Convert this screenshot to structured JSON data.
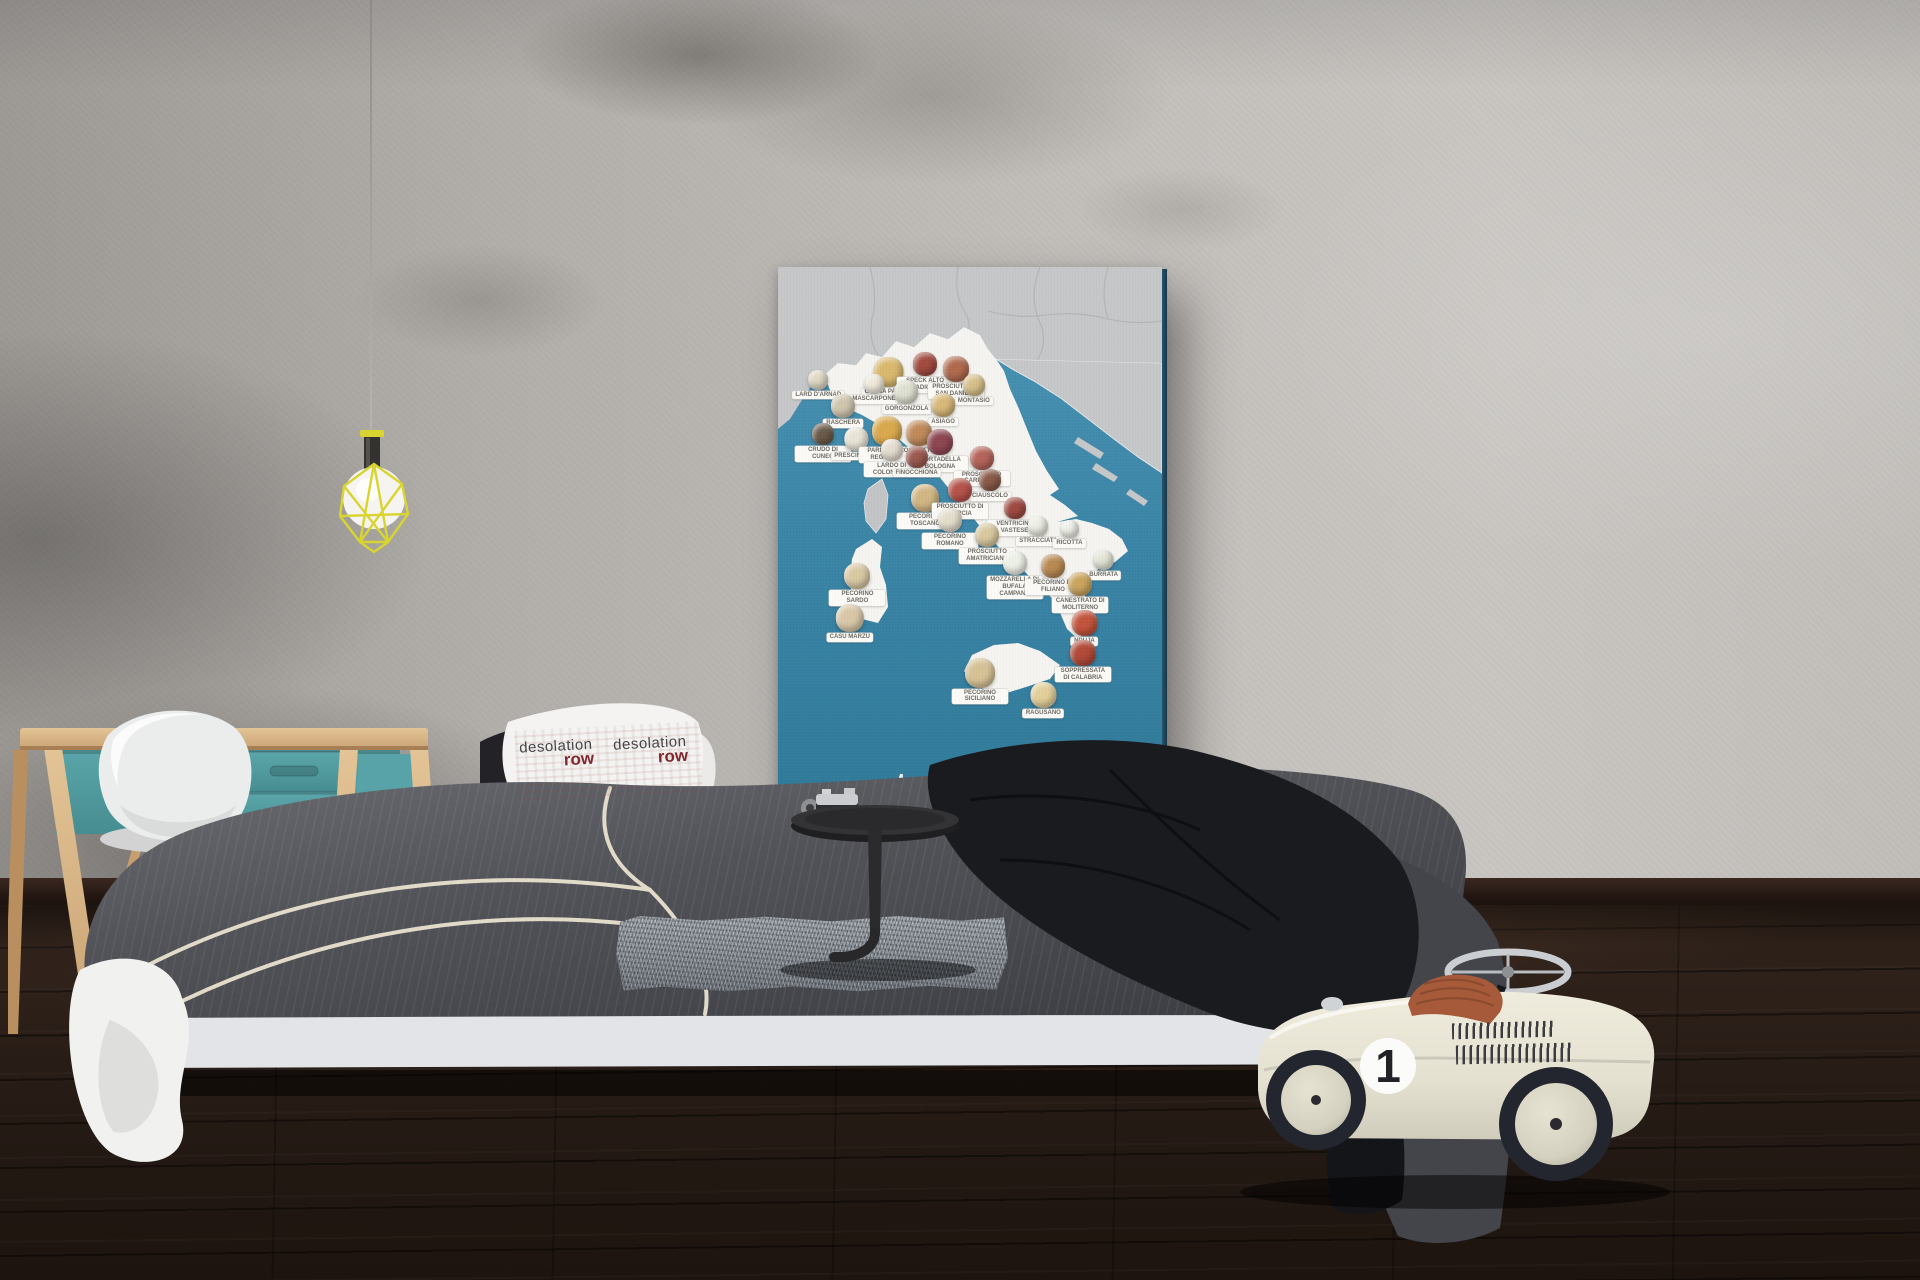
{
  "poster": {
    "brand_bold": "taste",
    "brand_light": "atlas",
    "url": "www.tasteatlas.com/italy",
    "sea_color": "#3e86a8",
    "land_color": "#c6c7c8",
    "italy_color": "#f5f4f0",
    "items": [
      {
        "label": "LARD D'ARNAD",
        "x": 10.5,
        "y": 17.8,
        "c": "#dfd8c4",
        "s": 20
      },
      {
        "label": "GRANA PADANO",
        "x": 28.9,
        "y": 15.7,
        "c": "#d9b86e",
        "s": 30
      },
      {
        "label": "SPECK ALTO ADIGE",
        "x": 38.3,
        "y": 14.8,
        "c": "#a24a40",
        "s": 24
      },
      {
        "label": "PROSCIUTTO DI SAN DANIELE",
        "x": 46.3,
        "y": 15.5,
        "c": "#b06a4e",
        "s": 26
      },
      {
        "label": "MONTASIO",
        "x": 51.0,
        "y": 18.5,
        "c": "#d8c08a",
        "s": 22
      },
      {
        "label": "MASCARPONE",
        "x": 25.0,
        "y": 18.6,
        "c": "#eee9da",
        "s": 20
      },
      {
        "label": "GORGONZOLA",
        "x": 33.5,
        "y": 19.6,
        "c": "#dde0cf",
        "s": 24
      },
      {
        "label": "ASIAGO",
        "x": 43.0,
        "y": 21.8,
        "c": "#d9b87a",
        "s": 24
      },
      {
        "label": "RASCHERA",
        "x": 17.0,
        "y": 22.1,
        "c": "#cfc6ae",
        "s": 24
      },
      {
        "label": "CRUDO DI CUNEO",
        "x": 11.7,
        "y": 27.1,
        "c": "#6b5b4a",
        "s": 22
      },
      {
        "label": "PRESCINSÊUA",
        "x": 20.3,
        "y": 27.7,
        "c": "#e9e4d6",
        "s": 24
      },
      {
        "label": "PARMIGIANO REGGIANO",
        "x": 28.3,
        "y": 25.9,
        "c": "#d9a94e",
        "s": 30
      },
      {
        "label": "PROSCIUTTO DI PARMA",
        "x": 36.7,
        "y": 26.5,
        "c": "#c08a5a",
        "s": 26
      },
      {
        "label": "MORTADELLA BOLOGNA",
        "x": 42.2,
        "y": 28.2,
        "c": "#8e4752",
        "s": 26
      },
      {
        "label": "LARDO DI COLONNATA",
        "x": 29.6,
        "y": 29.8,
        "c": "#e6ddd0",
        "s": 22
      },
      {
        "label": "FINOCCHIONA",
        "x": 36.1,
        "y": 31.0,
        "c": "#9c5a50",
        "s": 22
      },
      {
        "label": "PROSCIUTTO CARPEGNA",
        "x": 53.0,
        "y": 31.0,
        "c": "#b5645a",
        "s": 24
      },
      {
        "label": "CIAUSCOLO",
        "x": 55.2,
        "y": 35.1,
        "c": "#8a5a48",
        "s": 22
      },
      {
        "label": "PECORINO TOSCANO",
        "x": 38.3,
        "y": 37.7,
        "c": "#d2b684",
        "s": 28
      },
      {
        "label": "PROSCIUTTO DI NORCIA",
        "x": 47.4,
        "y": 36.7,
        "c": "#b5534a",
        "s": 24
      },
      {
        "label": "VENTRICINA VASTESE",
        "x": 61.6,
        "y": 40.0,
        "c": "#a04a42",
        "s": 22
      },
      {
        "label": "PECORINO ROMANO",
        "x": 44.8,
        "y": 41.9,
        "c": "#e4ddcb",
        "s": 24
      },
      {
        "label": "PROSCIUTTO AMATRICIANO",
        "x": 54.5,
        "y": 44.4,
        "c": "#d9c9a0",
        "s": 24
      },
      {
        "label": "STRACCIATA",
        "x": 67.8,
        "y": 43.2,
        "c": "#eceee4",
        "s": 20
      },
      {
        "label": "RICOTTA",
        "x": 75.9,
        "y": 44.0,
        "c": "#eff0e8",
        "s": 18
      },
      {
        "label": "MOZZARELLA DI BUFALA CAMPANA",
        "x": 61.6,
        "y": 49.3,
        "c": "#edf0e6",
        "s": 24
      },
      {
        "label": "PECORINO DI FILIANO",
        "x": 71.6,
        "y": 49.8,
        "c": "#b98a52",
        "s": 24
      },
      {
        "label": "BURRATA",
        "x": 84.8,
        "y": 49.1,
        "c": "#e3e6d6",
        "s": 20
      },
      {
        "label": "CANESTRATO DI MOLITERNO",
        "x": 78.7,
        "y": 53.0,
        "c": "#caa45e",
        "s": 24
      },
      {
        "label": "NDUJA",
        "x": 79.8,
        "y": 59.6,
        "c": "#c2543c",
        "s": 26
      },
      {
        "label": "SOPPRESSATA DI CALABRIA",
        "x": 79.4,
        "y": 64.7,
        "c": "#b24a38",
        "s": 26
      },
      {
        "label": "PECORINO SICILIANO",
        "x": 52.6,
        "y": 67.8,
        "c": "#d6c296",
        "s": 30
      },
      {
        "label": "RAGUSANO",
        "x": 69.1,
        "y": 72.0,
        "c": "#e2cf9a",
        "s": 26
      },
      {
        "label": "PECORINO SARDO",
        "x": 20.7,
        "y": 51.4,
        "c": "#d9c9a4",
        "s": 26
      },
      {
        "label": "CASU MARZU",
        "x": 18.7,
        "y": 58.5,
        "c": "#d8c8a8",
        "s": 28
      }
    ]
  },
  "pillow": {
    "word1": "desolation",
    "word2": "row"
  },
  "toy_car": {
    "number": "1"
  },
  "colors": {
    "wall": "#b9b6b2",
    "floor": "#241b16",
    "desk_teal": "#55a0a4",
    "lamp_yellow": "#d7d32e",
    "duvet_gray": "#54555a",
    "car_body": "#e9e5d6",
    "car_seat": "#a3583a"
  }
}
